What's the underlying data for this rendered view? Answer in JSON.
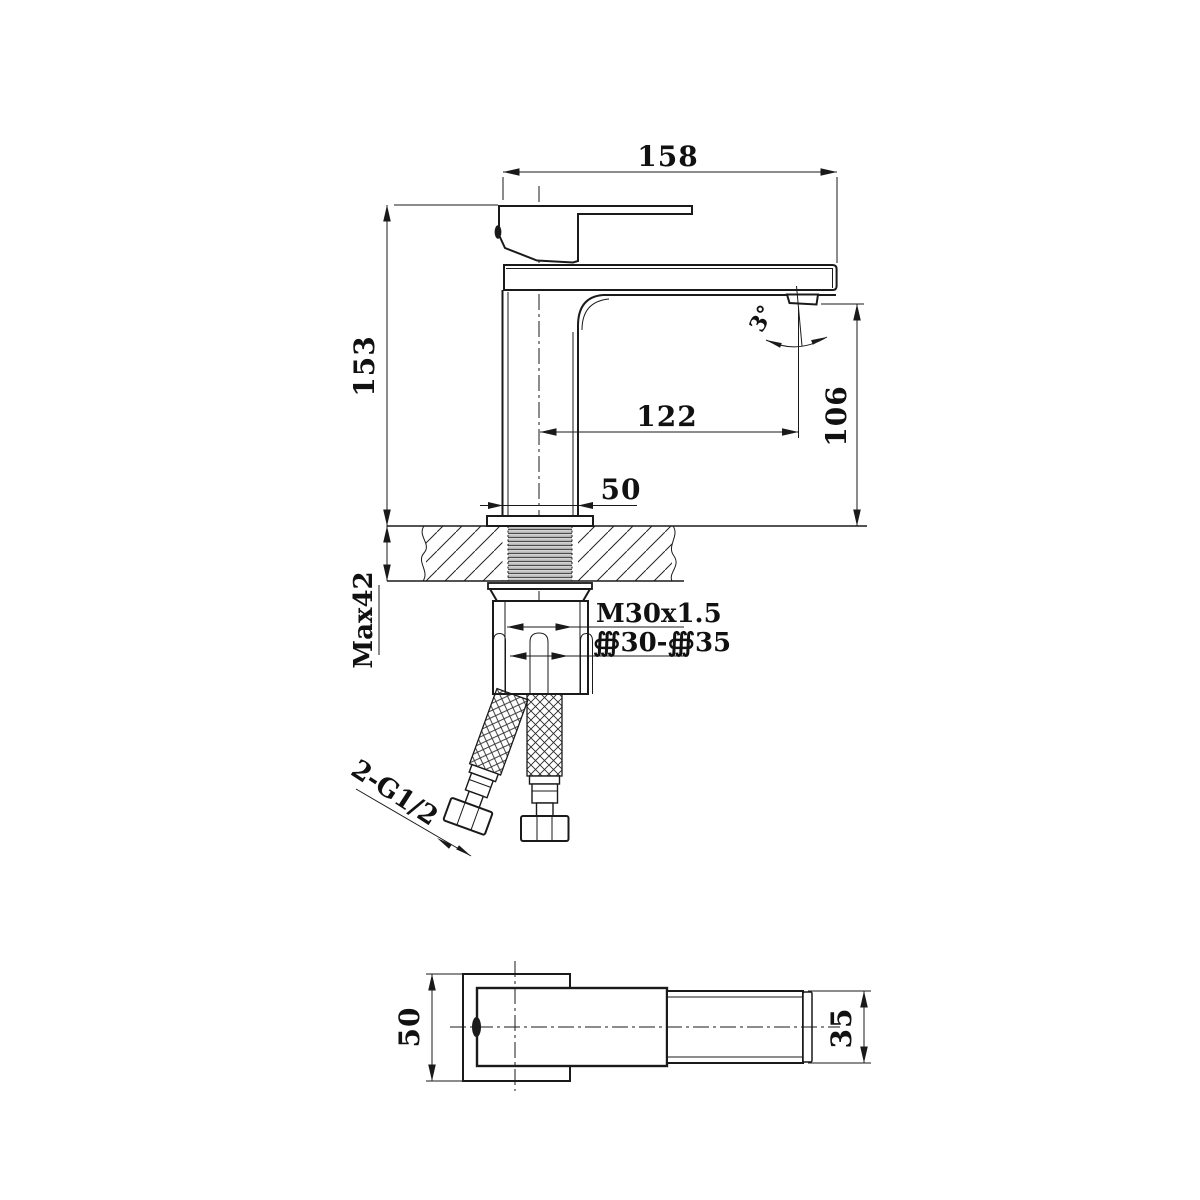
{
  "page": {
    "background": "#ffffff",
    "ink": "#1a1a1a"
  },
  "labels": {
    "spout_top_width": "158",
    "height_to_deck": "153",
    "center_to_outlet": "122",
    "outlet_to_deck": "106",
    "body_width": "50",
    "max_deck_thickness": "Max42",
    "mounting_thread": "M30x1.5",
    "hole_diameter_range": "∰30-∰35",
    "inlet_connections": "2-G1/2",
    "outlet_angle": "3°",
    "plan_body_width": "50",
    "plan_spout_diameter": "35"
  }
}
